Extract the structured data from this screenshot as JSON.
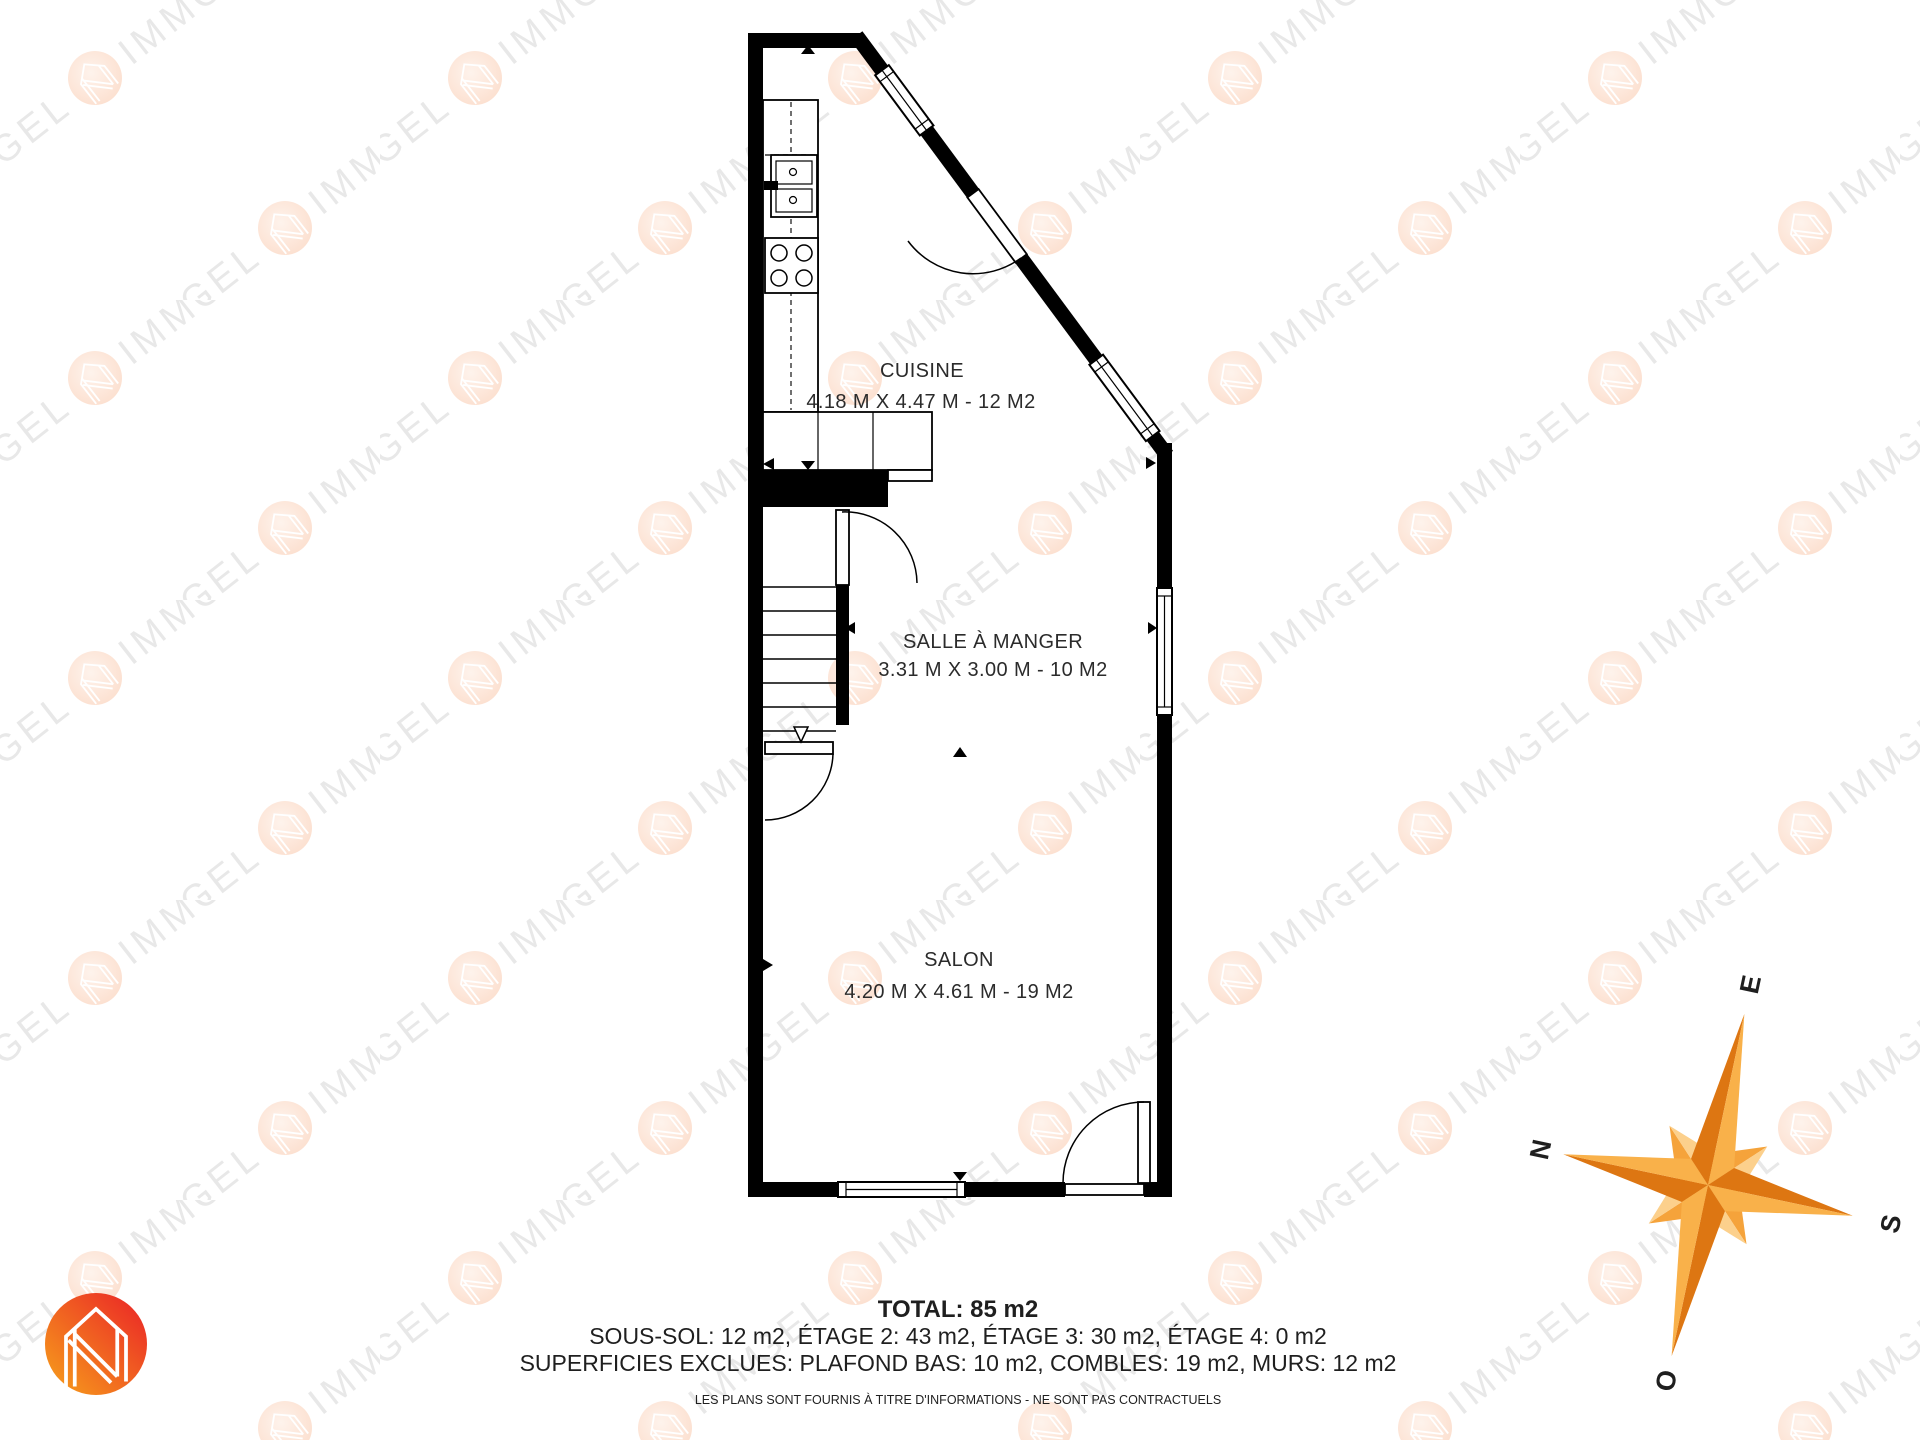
{
  "watermark": {
    "brand_word_1": "NIGEL",
    "brand_word_2": "IMMO"
  },
  "rooms": [
    {
      "name": "CUISINE",
      "dims": "4.18 M X 4.47 M - 12 M2"
    },
    {
      "name": "SALLE À MANGER",
      "dims": "3.31 M X 3.00 M - 10 M2"
    },
    {
      "name": "SALON",
      "dims": "4.20 M X 4.61 M - 19 M2"
    }
  ],
  "summary": {
    "total": "TOTAL: 85 m2",
    "floors": "SOUS-SOL: 12 m2, ÉTAGE 2: 43 m2, ÉTAGE 3: 30 m2, ÉTAGE 4: 0 m2",
    "excluded": "SUPERFICIES EXCLUES: PLAFOND BAS: 10 m2, COMBLES: 19 m2, MURS: 12 m2",
    "disclaimer": "LES PLANS SONT FOURNIS À TITRE D'INFORMATIONS - NE SONT PAS CONTRACTUELS"
  },
  "compass": {
    "north": "N",
    "east": "E",
    "south": "S",
    "west": "O"
  },
  "colors": {
    "walls": "#000000",
    "watermark_text": "#e8e8e8",
    "logo_gradient_start": "#f7a21b",
    "logo_gradient_end": "#ea2127",
    "compass_dark": "#dd7612",
    "compass_light": "#f9b14a"
  }
}
